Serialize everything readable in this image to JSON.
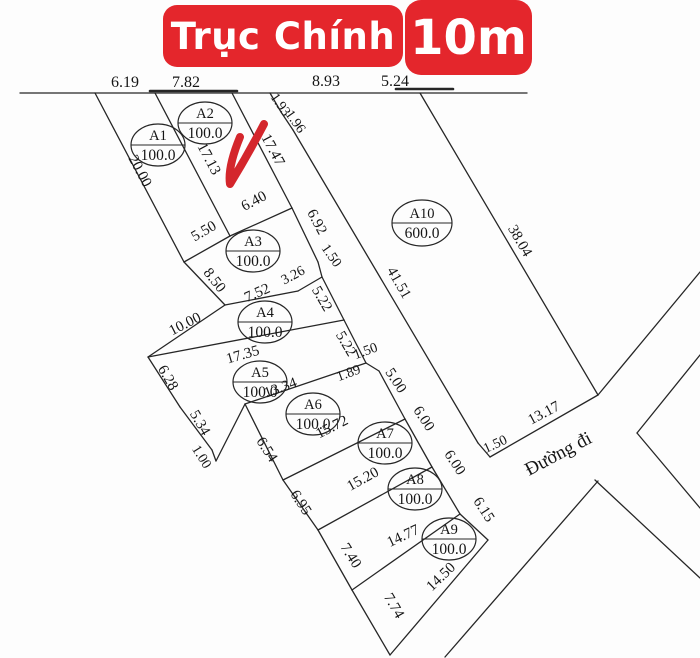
{
  "banner": {
    "main_label": "Trục Chính",
    "width_label": "10m",
    "bg_color": "#e4262c",
    "text_color": "#ffffff"
  },
  "map": {
    "background": "#fdfdfd",
    "line_color": "#262626",
    "text_color": "#151515",
    "road_label": {
      "t": "Đường đi",
      "x": 561,
      "y": 459,
      "r": -28,
      "fs": 19
    },
    "checkmark": {
      "color": "#d4262c",
      "width": 8,
      "path": "M240,137 C233,154 228,171 230,184 C241,166 253,145 264,124"
    },
    "segments": [
      {
        "x1": 20,
        "y1": 93,
        "x2": 527,
        "y2": 93
      },
      {
        "x1": 150,
        "y1": 91,
        "x2": 237,
        "y2": 91,
        "w": 2.6
      },
      {
        "x1": 396,
        "y1": 89,
        "x2": 453,
        "y2": 89,
        "w": 2.6
      },
      {
        "x1": 95,
        "y1": 93,
        "x2": 184,
        "y2": 262
      },
      {
        "x1": 155,
        "y1": 93,
        "x2": 230,
        "y2": 236
      },
      {
        "x1": 232,
        "y1": 93,
        "x2": 292,
        "y2": 208
      },
      {
        "x1": 184,
        "y1": 262,
        "x2": 230,
        "y2": 236
      },
      {
        "x1": 230,
        "y1": 236,
        "x2": 292,
        "y2": 208
      },
      {
        "x1": 292,
        "y1": 208,
        "x2": 318,
        "y2": 262
      },
      {
        "x1": 318,
        "y1": 262,
        "x2": 322,
        "y2": 277
      },
      {
        "x1": 184,
        "y1": 262,
        "x2": 225,
        "y2": 305
      },
      {
        "x1": 225,
        "y1": 305,
        "x2": 298,
        "y2": 291
      },
      {
        "x1": 298,
        "y1": 291,
        "x2": 322,
        "y2": 277
      },
      {
        "x1": 322,
        "y1": 277,
        "x2": 344,
        "y2": 320
      },
      {
        "x1": 344,
        "y1": 320,
        "x2": 366,
        "y2": 363
      },
      {
        "x1": 366,
        "y1": 363,
        "x2": 379,
        "y2": 371
      },
      {
        "x1": 225,
        "y1": 305,
        "x2": 148,
        "y2": 357
      },
      {
        "x1": 148,
        "y1": 357,
        "x2": 344,
        "y2": 320
      },
      {
        "x1": 148,
        "y1": 357,
        "x2": 180,
        "y2": 407
      },
      {
        "x1": 180,
        "y1": 407,
        "x2": 212,
        "y2": 450
      },
      {
        "x1": 212,
        "y1": 450,
        "x2": 216,
        "y2": 461
      },
      {
        "x1": 216,
        "y1": 461,
        "x2": 245,
        "y2": 404
      },
      {
        "x1": 245,
        "y1": 404,
        "x2": 366,
        "y2": 363
      },
      {
        "x1": 379,
        "y1": 371,
        "x2": 405,
        "y2": 419
      },
      {
        "x1": 245,
        "y1": 404,
        "x2": 283,
        "y2": 480
      },
      {
        "x1": 283,
        "y1": 480,
        "x2": 405,
        "y2": 419
      },
      {
        "x1": 405,
        "y1": 419,
        "x2": 432,
        "y2": 467
      },
      {
        "x1": 283,
        "y1": 480,
        "x2": 318,
        "y2": 530
      },
      {
        "x1": 318,
        "y1": 530,
        "x2": 432,
        "y2": 467
      },
      {
        "x1": 432,
        "y1": 467,
        "x2": 460,
        "y2": 514
      },
      {
        "x1": 318,
        "y1": 530,
        "x2": 352,
        "y2": 590
      },
      {
        "x1": 352,
        "y1": 590,
        "x2": 460,
        "y2": 514
      },
      {
        "x1": 460,
        "y1": 514,
        "x2": 488,
        "y2": 540
      },
      {
        "x1": 352,
        "y1": 590,
        "x2": 390,
        "y2": 655
      },
      {
        "x1": 390,
        "y1": 655,
        "x2": 488,
        "y2": 540
      },
      {
        "x1": 270,
        "y1": 93,
        "x2": 281,
        "y2": 112
      },
      {
        "x1": 281,
        "y1": 112,
        "x2": 293,
        "y2": 130
      },
      {
        "x1": 293,
        "y1": 130,
        "x2": 478,
        "y2": 443
      },
      {
        "x1": 478,
        "y1": 443,
        "x2": 490,
        "y2": 457
      },
      {
        "x1": 490,
        "y1": 457,
        "x2": 598,
        "y2": 395
      },
      {
        "x1": 420,
        "y1": 93,
        "x2": 598,
        "y2": 395
      },
      {
        "x1": 598,
        "y1": 395,
        "x2": 700,
        "y2": 272
      },
      {
        "x1": 637,
        "y1": 433,
        "x2": 700,
        "y2": 355
      },
      {
        "x1": 637,
        "y1": 433,
        "x2": 700,
        "y2": 508
      },
      {
        "x1": 595,
        "y1": 480,
        "x2": 700,
        "y2": 578
      },
      {
        "x1": 598,
        "y1": 481,
        "x2": 445,
        "y2": 657
      }
    ],
    "dim_labels": [
      {
        "t": "6.19",
        "x": 125,
        "y": 87,
        "r": 0,
        "fs": 16
      },
      {
        "t": "7.82",
        "x": 186,
        "y": 87,
        "r": 0,
        "fs": 16
      },
      {
        "t": "8.93",
        "x": 326,
        "y": 86,
        "r": 0,
        "fs": 16
      },
      {
        "t": "5.24",
        "x": 395,
        "y": 86,
        "r": 0,
        "fs": 16
      },
      {
        "t": "1.93",
        "x": 277,
        "y": 107,
        "r": 55,
        "fs": 14
      },
      {
        "t": "1.96",
        "x": 292,
        "y": 124,
        "r": 55,
        "fs": 14
      },
      {
        "t": "20.00",
        "x": 136,
        "y": 173,
        "r": 62
      },
      {
        "t": "17.13",
        "x": 205,
        "y": 161,
        "r": 62
      },
      {
        "t": "17.47",
        "x": 269,
        "y": 152,
        "r": 62
      },
      {
        "t": "5.50",
        "x": 206,
        "y": 235,
        "r": -30
      },
      {
        "t": "6.40",
        "x": 256,
        "y": 205,
        "r": -28
      },
      {
        "t": "6.92",
        "x": 313,
        "y": 224,
        "r": 62
      },
      {
        "t": "1.50",
        "x": 328,
        "y": 258,
        "r": 55,
        "fs": 14
      },
      {
        "t": "8.50",
        "x": 211,
        "y": 283,
        "r": 52
      },
      {
        "t": "7.52",
        "x": 259,
        "y": 297,
        "r": -24
      },
      {
        "t": "3.26",
        "x": 295,
        "y": 279,
        "r": -28,
        "fs": 14
      },
      {
        "t": "5.22",
        "x": 318,
        "y": 301,
        "r": 60
      },
      {
        "t": "5.22",
        "x": 342,
        "y": 346,
        "r": 60
      },
      {
        "t": "10.00",
        "x": 187,
        "y": 328,
        "r": -27
      },
      {
        "t": "17.35",
        "x": 244,
        "y": 359,
        "r": -16
      },
      {
        "t": "6.28",
        "x": 164,
        "y": 380,
        "r": 60
      },
      {
        "t": "5.34",
        "x": 196,
        "y": 425,
        "r": 60
      },
      {
        "t": "1.00",
        "x": 198,
        "y": 459,
        "r": 58,
        "fs": 14
      },
      {
        "t": "13.34",
        "x": 282,
        "y": 392,
        "r": -20
      },
      {
        "t": "1.50",
        "x": 367,
        "y": 355,
        "r": -20,
        "fs": 14
      },
      {
        "t": "1.89",
        "x": 350,
        "y": 377,
        "r": -20,
        "fs": 14
      },
      {
        "t": "5.00",
        "x": 392,
        "y": 383,
        "r": 57
      },
      {
        "t": "41.51",
        "x": 395,
        "y": 285,
        "r": 60
      },
      {
        "t": "38.04",
        "x": 516,
        "y": 243,
        "r": 60
      },
      {
        "t": "13.17",
        "x": 546,
        "y": 417,
        "r": -28
      },
      {
        "t": "6.54",
        "x": 263,
        "y": 452,
        "r": 57
      },
      {
        "t": "15.72",
        "x": 334,
        "y": 431,
        "r": -27
      },
      {
        "t": "6.00",
        "x": 420,
        "y": 421,
        "r": 57
      },
      {
        "t": "6.95",
        "x": 297,
        "y": 505,
        "r": 57
      },
      {
        "t": "15.20",
        "x": 365,
        "y": 483,
        "r": -29
      },
      {
        "t": "6.00",
        "x": 451,
        "y": 465,
        "r": 57
      },
      {
        "t": "6.15",
        "x": 480,
        "y": 512,
        "r": 57
      },
      {
        "t": "7.40",
        "x": 347,
        "y": 558,
        "r": 58
      },
      {
        "t": "14.77",
        "x": 405,
        "y": 540,
        "r": -25
      },
      {
        "t": "14.50",
        "x": 444,
        "y": 580,
        "r": -44
      },
      {
        "t": "7.74",
        "x": 390,
        "y": 608,
        "r": 60
      },
      {
        "t": "1.50",
        "x": 497,
        "y": 448,
        "r": -25,
        "fs": 14
      }
    ],
    "parcels": [
      {
        "id": "A1",
        "area": "100.0",
        "x": 158,
        "y": 145,
        "rx": 27,
        "ry": 21
      },
      {
        "id": "A2",
        "area": "100.0",
        "x": 205,
        "y": 123,
        "rx": 27,
        "ry": 21
      },
      {
        "id": "A3",
        "area": "100.0",
        "x": 253,
        "y": 251,
        "rx": 27,
        "ry": 21
      },
      {
        "id": "A4",
        "area": "100.0",
        "x": 265,
        "y": 322,
        "rx": 27,
        "ry": 21
      },
      {
        "id": "A5",
        "area": "100.0",
        "x": 260,
        "y": 382,
        "rx": 27,
        "ry": 21
      },
      {
        "id": "A6",
        "area": "100.0",
        "x": 313,
        "y": 414,
        "rx": 27,
        "ry": 21
      },
      {
        "id": "A7",
        "area": "100.0",
        "x": 385,
        "y": 443,
        "rx": 27,
        "ry": 21
      },
      {
        "id": "A8",
        "area": "100.0",
        "x": 415,
        "y": 489,
        "rx": 27,
        "ry": 21
      },
      {
        "id": "A9",
        "area": "100.0",
        "x": 449,
        "y": 539,
        "rx": 27,
        "ry": 21
      },
      {
        "id": "A10",
        "area": "600.0",
        "x": 422,
        "y": 223,
        "rx": 30,
        "ry": 23
      }
    ]
  }
}
